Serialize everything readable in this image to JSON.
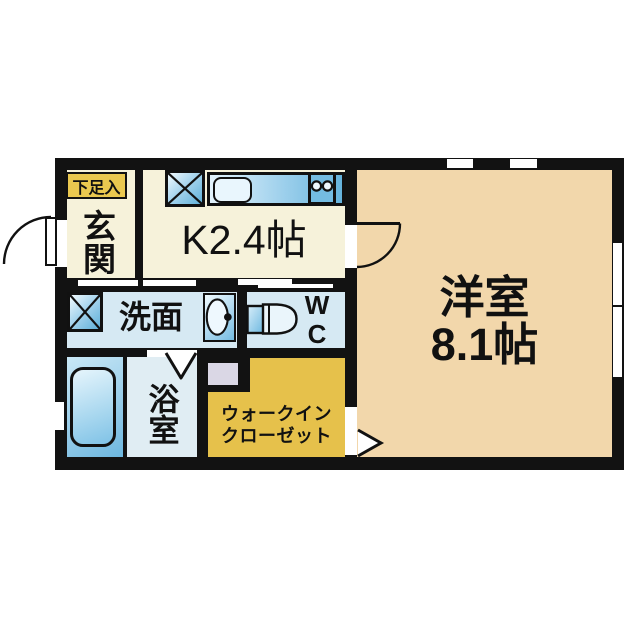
{
  "plan": {
    "type": "japanese-apartment-floor-plan",
    "rooms": {
      "entrance": {
        "label": "玄関",
        "shoe_cabinet_label": "下足入"
      },
      "kitchen": {
        "label": "K2.4帖"
      },
      "washroom": {
        "label": "洗面"
      },
      "toilet": {
        "label_line1": "W",
        "label_line2": "C"
      },
      "bathroom": {
        "label": "浴室"
      },
      "walk_in_closet": {
        "label_line1": "ウォークイン",
        "label_line2": "クローゼット"
      },
      "western_room": {
        "label_line1": "洋室",
        "label_line2": "8.1帖"
      }
    },
    "icons": {
      "appliance_space": "crossed-box",
      "kitchen_sink": "rounded-rectangle",
      "stove": "two-burner-circles",
      "vanity_sink": "oval-basin-with-faucet-dot",
      "toilet": "tank-and-bowl",
      "bathtub": "rounded-tub",
      "door_swing": "quarter-arc",
      "folding_bath_door": "v-mark",
      "closet_entry_arrow": "right-triangle"
    },
    "colors": {
      "wall": "#121212",
      "kitchen_entrance_floor": "#f6f2da",
      "western_room_floor": "#f2d7ab",
      "wet_area_floor": "#d6e9f3",
      "bathroom_floor": "#e0edf3",
      "closet_floor": "#e6c14b",
      "shoe_label_bg": "#eac84f",
      "fixture_blue": "#5fb0d8",
      "lavender_square": "#dad7e5"
    }
  }
}
